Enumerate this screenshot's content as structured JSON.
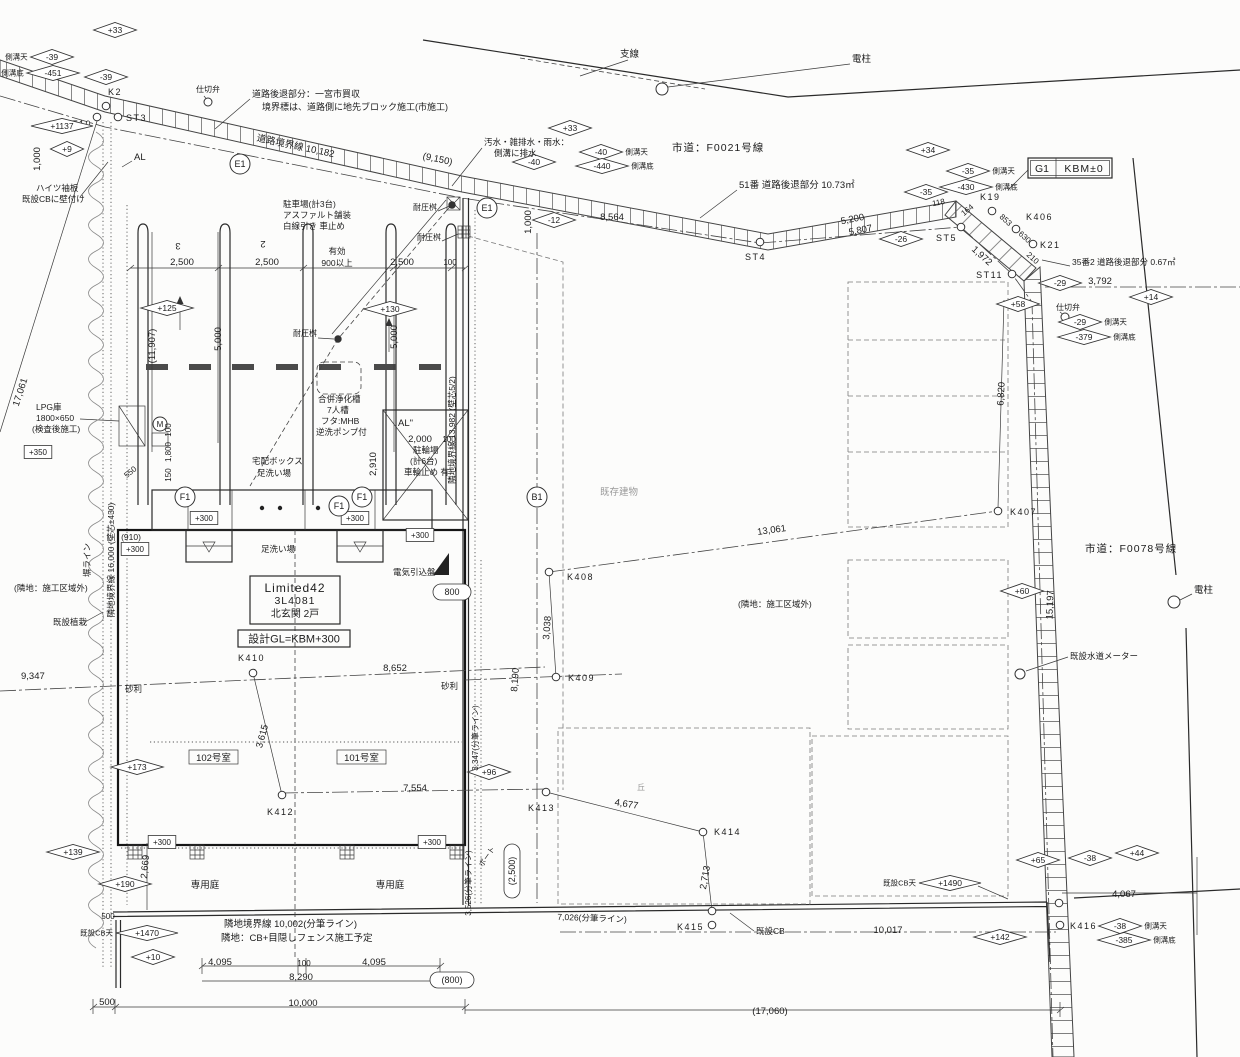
{
  "title_block": {
    "product": "Limited42",
    "model": "3L4081",
    "entrance": "北玄関  2戸",
    "design_gl": "設計GL=KBM+300"
  },
  "benchmark": {
    "g1": "G1",
    "kbm": "KBM±0"
  },
  "roads": {
    "north": "市道：F0021号線",
    "east": "市道：F0078号線"
  },
  "rooms": {
    "r102": "102号室",
    "r101": "101号室",
    "garden": "専用庭"
  },
  "annotations": {
    "notes": [
      {
        "t": "仕切弁",
        "x": 196,
        "y": 92,
        "a": "s",
        "s": 8
      },
      {
        "t": "道路後退部分：一宮市買収",
        "x": 252,
        "y": 97,
        "a": "s",
        "s": 9
      },
      {
        "t": "境界標は、道路側に地先ブロック施工(市施工)",
        "x": 262,
        "y": 110,
        "a": "s",
        "s": 9
      },
      {
        "t": "支線",
        "x": 620,
        "y": 57,
        "a": "s"
      },
      {
        "t": "電柱",
        "x": 852,
        "y": 62,
        "a": "s"
      },
      {
        "t": "ハイツ袖板",
        "x": 36,
        "y": 191,
        "a": "s",
        "s": 8.5
      },
      {
        "t": "既設CBに壁付け",
        "x": 22,
        "y": 202,
        "a": "s",
        "s": 8.5
      },
      {
        "t": "AL",
        "x": 134,
        "y": 160,
        "a": "s"
      },
      {
        "t": "汚水・雑排水・雨水：",
        "x": 484,
        "y": 145,
        "a": "s",
        "s": 8.5
      },
      {
        "t": "側溝に排水",
        "x": 494,
        "y": 156,
        "a": "s",
        "s": 8.5
      },
      {
        "t": "51番 道路後退部分 10.73㎡",
        "x": 739,
        "y": 188,
        "a": "s",
        "s": 9.5
      },
      {
        "t": "35番2 道路後退部分 0.67㎡",
        "x": 1072,
        "y": 265,
        "a": "s",
        "s": 8.5
      },
      {
        "t": "駐車場(計3台)",
        "x": 283,
        "y": 207,
        "a": "s",
        "s": 8.5
      },
      {
        "t": "アスファルト舗装",
        "x": 283,
        "y": 218,
        "a": "s",
        "s": 8.5
      },
      {
        "t": "白線引き 車止め",
        "x": 283,
        "y": 229,
        "a": "s",
        "s": 8.5
      },
      {
        "t": "耐圧桝",
        "x": 413,
        "y": 210,
        "a": "s",
        "s": 8
      },
      {
        "t": "耐圧桝",
        "x": 417,
        "y": 240,
        "a": "s",
        "s": 8
      },
      {
        "t": "耐圧桝",
        "x": 293,
        "y": 336,
        "a": "s",
        "s": 8
      },
      {
        "t": "合併浄化槽",
        "x": 318,
        "y": 402,
        "a": "s",
        "s": 8.5
      },
      {
        "t": "7人槽",
        "x": 327,
        "y": 413,
        "a": "s",
        "s": 8.5
      },
      {
        "t": "フタ:MHB",
        "x": 321,
        "y": 424,
        "a": "s",
        "s": 8.5
      },
      {
        "t": "逆洗ポンプ付",
        "x": 316,
        "y": 435,
        "a": "s",
        "s": 8.5
      },
      {
        "t": "AL\"",
        "x": 398,
        "y": 426,
        "a": "s"
      },
      {
        "t": "駐輪場",
        "x": 413,
        "y": 453,
        "a": "s",
        "s": 8.5
      },
      {
        "t": "(計6台)",
        "x": 410,
        "y": 464,
        "a": "s",
        "s": 8.5
      },
      {
        "t": "車輪止め 有",
        "x": 404,
        "y": 475,
        "a": "s",
        "s": 8.5
      },
      {
        "t": "宅配ボックス",
        "x": 252,
        "y": 464,
        "a": "s",
        "s": 8.5
      },
      {
        "t": "足洗い場",
        "x": 257,
        "y": 476,
        "a": "s",
        "s": 8.5
      },
      {
        "t": "足洗い場",
        "x": 261,
        "y": 552,
        "a": "s",
        "s": 8.5
      },
      {
        "t": "LPG庫",
        "x": 36,
        "y": 410,
        "a": "s",
        "s": 8.5
      },
      {
        "t": "1800×650",
        "x": 36,
        "y": 421,
        "a": "s",
        "s": 8.5
      },
      {
        "t": "(検査後施工)",
        "x": 32,
        "y": 432,
        "a": "s",
        "s": 8.5
      },
      {
        "t": "電気引込盤",
        "x": 393,
        "y": 575,
        "a": "s",
        "s": 8.5
      },
      {
        "t": "既存建物",
        "x": 600,
        "y": 495,
        "a": "s",
        "c": "g"
      },
      {
        "t": "(隣地：施工区域外)",
        "x": 738,
        "y": 607,
        "a": "s",
        "s": 8.5
      },
      {
        "t": "(隣地：施工区域外)",
        "x": 14,
        "y": 591,
        "a": "s",
        "s": 8.5
      },
      {
        "t": "既設植栽",
        "x": 53,
        "y": 625,
        "a": "s",
        "s": 8.5
      },
      {
        "t": "砂利",
        "x": 125,
        "y": 692,
        "a": "s",
        "s": 8.5
      },
      {
        "t": "砂利",
        "x": 441,
        "y": 689,
        "a": "s",
        "s": 8.5
      },
      {
        "t": "隣地境界線 10,002(分筆ライン)",
        "x": 224,
        "y": 927,
        "a": "s",
        "s": 9.5
      },
      {
        "t": "隣地：CB+目隠しフェンス施工予定",
        "x": 221,
        "y": 941,
        "a": "s",
        "s": 9.5
      },
      {
        "t": "既設CB",
        "x": 756,
        "y": 934,
        "a": "s",
        "s": 8.5
      },
      {
        "t": "既設水道メーター",
        "x": 1070,
        "y": 659,
        "a": "s",
        "s": 8.5
      },
      {
        "t": "電柱",
        "x": 1194,
        "y": 593,
        "a": "s"
      },
      {
        "t": "仕切弁",
        "x": 1056,
        "y": 310,
        "a": "s",
        "s": 8
      },
      {
        "t": "有効",
        "x": 337,
        "y": 254,
        "s": 8.5
      },
      {
        "t": "900以上",
        "x": 337,
        "y": 266,
        "s": 8.5
      },
      {
        "t": "道路境界線 10,182",
        "x": 295,
        "y": 149,
        "r": 12,
        "s": 9.5
      },
      {
        "t": "隣地境界線 13,982 (壁芯5/2)",
        "x": 455,
        "y": 430,
        "r": -90,
        "s": 8.5
      },
      {
        "t": "隣地境界線 16,000 (壁芯±430)",
        "x": 114,
        "y": 560,
        "r": -90,
        "s": 8.5
      },
      {
        "t": "塀ライン",
        "x": 90,
        "y": 560,
        "r": -90,
        "s": 8.5
      },
      {
        "t": "3",
        "x": 178,
        "y": 243,
        "r": 180
      },
      {
        "t": "2",
        "x": 263,
        "y": 241,
        "r": 180
      },
      {
        "t": "丘",
        "x": 641,
        "y": 790,
        "s": 8,
        "c": "g"
      },
      {
        "t": "ポート",
        "x": 489,
        "y": 858,
        "r": -55,
        "s": 7.5
      },
      {
        "t": "(910)",
        "x": 131,
        "y": 540,
        "s": 8.5
      },
      {
        "t": "550",
        "x": 132,
        "y": 474,
        "r": -40,
        "s": 8
      }
    ],
    "dims": [
      {
        "t": "(9,150)",
        "x": 437,
        "y": 162,
        "r": 12
      },
      {
        "t": "8,564",
        "x": 612,
        "y": 220
      },
      {
        "t": "1,000",
        "x": 531,
        "y": 222,
        "r": -90
      },
      {
        "t": "1,000",
        "x": 40,
        "y": 159,
        "r": -90
      },
      {
        "t": "2,500",
        "x": 182,
        "y": 265
      },
      {
        "t": "2,500",
        "x": 267,
        "y": 265
      },
      {
        "t": "2,500",
        "x": 402,
        "y": 265
      },
      {
        "t": "100",
        "x": 450,
        "y": 265,
        "s": 8
      },
      {
        "t": "5,000",
        "x": 221,
        "y": 339,
        "r": -90
      },
      {
        "t": "5,000",
        "x": 397,
        "y": 337,
        "r": -90
      },
      {
        "t": "(11,907)",
        "x": 155,
        "y": 346,
        "r": -90
      },
      {
        "t": "2,000",
        "x": 420,
        "y": 442
      },
      {
        "t": "100",
        "x": 449,
        "y": 442,
        "s": 8
      },
      {
        "t": "2,910",
        "x": 376,
        "y": 464,
        "r": -90
      },
      {
        "t": "100",
        "x": 171,
        "y": 430,
        "r": -90,
        "s": 8
      },
      {
        "t": "1,800",
        "x": 171,
        "y": 452,
        "r": -90,
        "s": 8
      },
      {
        "t": "150",
        "x": 171,
        "y": 475,
        "r": -90,
        "s": 8
      },
      {
        "t": "5,200",
        "x": 853,
        "y": 222,
        "r": -11
      },
      {
        "t": "5,807",
        "x": 861,
        "y": 233,
        "r": -11
      },
      {
        "t": "118",
        "x": 939,
        "y": 205,
        "r": -11,
        "s": 8
      },
      {
        "t": "164",
        "x": 969,
        "y": 212,
        "r": -40,
        "s": 8
      },
      {
        "t": "853",
        "x": 1004,
        "y": 222,
        "r": 42,
        "s": 8
      },
      {
        "t": "630",
        "x": 1023,
        "y": 239,
        "r": 42,
        "s": 8
      },
      {
        "t": "210",
        "x": 1031,
        "y": 260,
        "r": 42,
        "s": 8
      },
      {
        "t": "1,972",
        "x": 980,
        "y": 258,
        "r": 42
      },
      {
        "t": "3,792",
        "x": 1100,
        "y": 284
      },
      {
        "t": "6,820",
        "x": 1004,
        "y": 394,
        "r": -87
      },
      {
        "t": "15,197",
        "x": 1053,
        "y": 605,
        "r": -88
      },
      {
        "t": "13,061",
        "x": 772,
        "y": 533,
        "r": -8
      },
      {
        "t": "3,038",
        "x": 550,
        "y": 628,
        "r": -86
      },
      {
        "t": "8,190",
        "x": 518,
        "y": 680,
        "r": -86
      },
      {
        "t": "8,652",
        "x": 395,
        "y": 671
      },
      {
        "t": "9,347",
        "x": 21,
        "y": 679,
        "a": "s"
      },
      {
        "t": "3,615",
        "x": 265,
        "y": 737,
        "r": -75
      },
      {
        "t": "7,554",
        "x": 415,
        "y": 791
      },
      {
        "t": "4,677",
        "x": 626,
        "y": 807,
        "r": 9
      },
      {
        "t": "2,713",
        "x": 708,
        "y": 878,
        "r": -80
      },
      {
        "t": "7,026(分筆ライン)",
        "x": 592,
        "y": 921,
        "r": 2,
        "s": 8.5
      },
      {
        "t": "10,017",
        "x": 888,
        "y": 933
      },
      {
        "t": "4,067",
        "x": 1124,
        "y": 897
      },
      {
        "t": "2,669",
        "x": 148,
        "y": 867,
        "r": -85
      },
      {
        "t": "500",
        "x": 108,
        "y": 919,
        "s": 8
      },
      {
        "t": "4,095",
        "x": 220,
        "y": 965
      },
      {
        "t": "100",
        "x": 304,
        "y": 966,
        "s": 8
      },
      {
        "t": "4,095",
        "x": 374,
        "y": 965
      },
      {
        "t": "8,290",
        "x": 301,
        "y": 980
      },
      {
        "t": "500",
        "x": 107,
        "y": 1005
      },
      {
        "t": "10,000",
        "x": 303,
        "y": 1006
      },
      {
        "t": "(17,060)",
        "x": 770,
        "y": 1014
      },
      {
        "t": "3,347(分筆ライン)",
        "x": 478,
        "y": 738,
        "r": -90,
        "s": 8
      },
      {
        "t": "3,526(分筆ライン)",
        "x": 471,
        "y": 883,
        "r": -90,
        "s": 8
      },
      {
        "t": "17,061",
        "x": 23,
        "y": 393,
        "r": -72
      }
    ],
    "diamonds": [
      {
        "v": "+33",
        "x": 115,
        "y": 30
      },
      {
        "v": "-39",
        "x": 52,
        "y": 57,
        "label": "側溝天",
        "side": "l"
      },
      {
        "v": "-451",
        "x": 53,
        "y": 73,
        "label": "側溝底",
        "side": "l"
      },
      {
        "v": "-39",
        "x": 106,
        "y": 77
      },
      {
        "v": "+1137",
        "x": 62,
        "y": 126
      },
      {
        "v": "+9",
        "x": 67,
        "y": 149
      },
      {
        "v": "+33",
        "x": 570,
        "y": 128
      },
      {
        "v": "-40",
        "x": 534,
        "y": 162
      },
      {
        "v": "-40",
        "x": 601,
        "y": 152,
        "label": "側溝天",
        "side": "r"
      },
      {
        "v": "-440",
        "x": 602,
        "y": 166,
        "label": "側溝底",
        "side": "r"
      },
      {
        "v": "-12",
        "x": 554,
        "y": 220
      },
      {
        "v": "+34",
        "x": 928,
        "y": 150
      },
      {
        "v": "-35",
        "x": 968,
        "y": 171,
        "label": "側溝天",
        "side": "r"
      },
      {
        "v": "-430",
        "x": 966,
        "y": 187,
        "label": "側溝底",
        "side": "r"
      },
      {
        "v": "-35",
        "x": 926,
        "y": 192
      },
      {
        "v": "-26",
        "x": 901,
        "y": 239
      },
      {
        "v": "-29",
        "x": 1060,
        "y": 283
      },
      {
        "v": "+14",
        "x": 1151,
        "y": 297
      },
      {
        "v": "+58",
        "x": 1018,
        "y": 304
      },
      {
        "v": "-29",
        "x": 1080,
        "y": 322,
        "label": "側溝天",
        "side": "r"
      },
      {
        "v": "-379",
        "x": 1084,
        "y": 337,
        "label": "側溝底",
        "side": "r"
      },
      {
        "v": "+125",
        "x": 167,
        "y": 308
      },
      {
        "v": "+130",
        "x": 390,
        "y": 309
      },
      {
        "v": "+60",
        "x": 1022,
        "y": 591
      },
      {
        "v": "+173",
        "x": 137,
        "y": 767
      },
      {
        "v": "+96",
        "x": 489,
        "y": 772
      },
      {
        "v": "+139",
        "x": 73,
        "y": 852
      },
      {
        "v": "+190",
        "x": 125,
        "y": 884
      },
      {
        "v": "+1470",
        "x": 147,
        "y": 933,
        "label": "既設CB天",
        "side": "l"
      },
      {
        "v": "+10",
        "x": 153,
        "y": 957
      },
      {
        "v": "+65",
        "x": 1038,
        "y": 860
      },
      {
        "v": "-38",
        "x": 1090,
        "y": 858
      },
      {
        "v": "+44",
        "x": 1137,
        "y": 853
      },
      {
        "v": "+1490",
        "x": 950,
        "y": 883,
        "label": "既設CB天",
        "side": "l"
      },
      {
        "v": "+142",
        "x": 1000,
        "y": 937
      },
      {
        "v": "-38",
        "x": 1120,
        "y": 926,
        "label": "側溝天",
        "side": "r"
      },
      {
        "v": "-385",
        "x": 1124,
        "y": 940,
        "label": "側溝底",
        "side": "r"
      }
    ],
    "level_boxes": [
      {
        "v": "+350",
        "x": 38,
        "y": 452
      },
      {
        "v": "+300",
        "x": 135,
        "y": 549
      },
      {
        "v": "+300",
        "x": 204,
        "y": 518
      },
      {
        "v": "+300",
        "x": 355,
        "y": 518
      },
      {
        "v": "+300",
        "x": 420,
        "y": 535
      },
      {
        "v": "+300",
        "x": 162,
        "y": 842
      },
      {
        "v": "+300",
        "x": 432,
        "y": 842
      }
    ],
    "survey_points": [
      {
        "n": "K2",
        "cx": 106,
        "cy": 106,
        "lx": 108,
        "ly": 95,
        "a": "s"
      },
      {
        "n": "T10",
        "cx": 97,
        "cy": 117,
        "lx": 92,
        "ly": 127,
        "a": "e"
      },
      {
        "n": "ST3",
        "cx": 118,
        "cy": 117,
        "lx": 126,
        "ly": 121,
        "a": "s"
      },
      {
        "n": "ST4",
        "cx": 760,
        "cy": 242,
        "lx": 745,
        "ly": 260,
        "a": "s"
      },
      {
        "n": "ST5",
        "cx": 961,
        "cy": 227,
        "lx": 936,
        "ly": 241,
        "a": "s"
      },
      {
        "n": "ST11",
        "cx": 1012,
        "cy": 274,
        "lx": 1003,
        "ly": 278,
        "a": "e"
      },
      {
        "n": "K19",
        "cx": 992,
        "cy": 211,
        "lx": 980,
        "ly": 200,
        "a": "s"
      },
      {
        "n": "K406",
        "cx": 1016,
        "cy": 229,
        "lx": 1026,
        "ly": 220,
        "a": "s"
      },
      {
        "n": "K21",
        "cx": 1033,
        "cy": 244,
        "lx": 1040,
        "ly": 248,
        "a": "s"
      },
      {
        "n": "K407",
        "cx": 998,
        "cy": 511,
        "lx": 1010,
        "ly": 515,
        "a": "s"
      },
      {
        "n": "K408",
        "cx": 549,
        "cy": 572,
        "lx": 567,
        "ly": 580,
        "a": "s"
      },
      {
        "n": "K409",
        "cx": 556,
        "cy": 677,
        "lx": 568,
        "ly": 681,
        "a": "s"
      },
      {
        "n": "K410",
        "cx": 253,
        "cy": 673,
        "lx": 238,
        "ly": 661,
        "a": "s"
      },
      {
        "n": "K412",
        "cx": 282,
        "cy": 795,
        "lx": 267,
        "ly": 815,
        "a": "s"
      },
      {
        "n": "K413",
        "cx": 546,
        "cy": 792,
        "lx": 528,
        "ly": 811,
        "a": "s"
      },
      {
        "n": "K414",
        "cx": 703,
        "cy": 832,
        "lx": 714,
        "ly": 835,
        "a": "s"
      },
      {
        "n": "K415",
        "cx": 712,
        "cy": 925,
        "lx": 677,
        "ly": 930,
        "a": "s"
      },
      {
        "n": "K416",
        "cx": 1060,
        "cy": 925,
        "lx": 1070,
        "ly": 929,
        "a": "s"
      }
    ],
    "circled_marks": [
      {
        "v": "E1",
        "x": 240,
        "y": 164
      },
      {
        "v": "E1",
        "x": 487,
        "y": 208
      },
      {
        "v": "B1",
        "x": 537,
        "y": 497
      },
      {
        "v": "F1",
        "x": 185,
        "y": 497
      },
      {
        "v": "F1",
        "x": 339,
        "y": 506
      },
      {
        "v": "F1",
        "x": 362,
        "y": 497
      },
      {
        "v": "M",
        "x": 160,
        "y": 424,
        "r": 7
      }
    ],
    "ovals": [
      {
        "t": "800",
        "x": 452,
        "y": 592,
        "w": 38
      },
      {
        "t": "(800)",
        "x": 452,
        "y": 980,
        "w": 44
      },
      {
        "t": "(2,500)",
        "x": 512,
        "y": 871,
        "w": 54,
        "r": -90
      }
    ],
    "symbols": [
      {
        "k": "valve",
        "x": 208,
        "y": 102,
        "r": 4
      },
      {
        "k": "valve",
        "x": 1065,
        "y": 317,
        "r": 4
      },
      {
        "k": "utility-pole",
        "x": 662,
        "y": 89,
        "r": 6
      },
      {
        "k": "utility-pole",
        "x": 1174,
        "y": 602,
        "r": 6
      },
      {
        "k": "water-meter",
        "x": 1020,
        "y": 674,
        "r": 5
      },
      {
        "k": "point",
        "x": 712,
        "y": 911,
        "r": 3.8
      },
      {
        "k": "point",
        "x": 1059,
        "y": 903,
        "r": 3.8
      },
      {
        "k": "pit",
        "x": 338,
        "y": 339,
        "r": 3.2,
        "f": 1
      },
      {
        "k": "pit",
        "x": 452,
        "y": 205,
        "r": 3.2,
        "f": 1
      }
    ]
  }
}
